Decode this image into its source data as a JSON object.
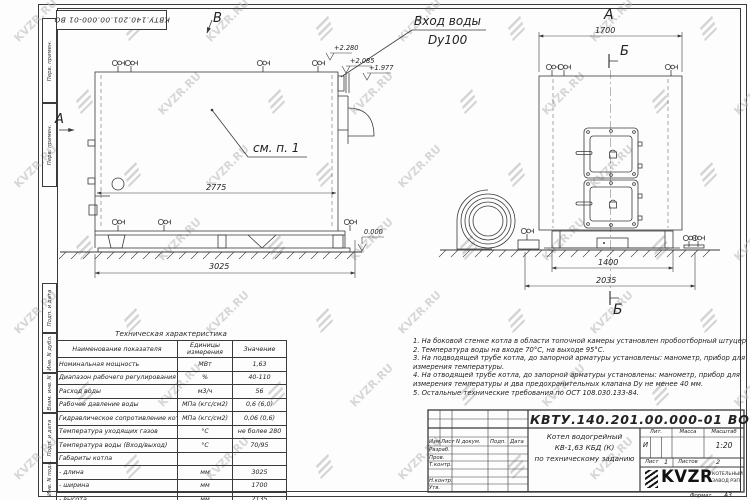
{
  "doc": {
    "number": "КВТУ.140.201.00.000-01 ВО"
  },
  "watermark": {
    "text": "KVZR.RU"
  },
  "frame": {
    "side_labels": [
      {
        "label": "Перв. примен."
      },
      {
        "label": "Перв. примен."
      },
      {
        "label": "Подп. и дата"
      },
      {
        "label": "Инв. N дубл."
      },
      {
        "label": "Взам. инв. N"
      },
      {
        "label": "Подп. и дата"
      },
      {
        "label": "Инв. N подл."
      }
    ]
  },
  "drawing": {
    "view_b": "В",
    "view_a_arrow": "А",
    "view_a_title": "А",
    "section_b_top": "Б",
    "section_b_bottom": "Б",
    "inlet_line1": "Вход воды",
    "inlet_line2": "Dy100",
    "see_note": "см. п. 1",
    "elev_2280": "+2.280",
    "elev_2085": "+2.085",
    "elev_1977": "+1.977",
    "elev_0": "0.000",
    "dim_2775": "2775",
    "dim_3025": "3025",
    "dim_1700": "1700",
    "dim_1400": "1400",
    "dim_2035": "2035"
  },
  "table": {
    "title": "Техническая характеристика",
    "headers": [
      "Наименование показателя",
      "Единицы измерения",
      "Значение"
    ],
    "rows": [
      [
        "Номинальная мощность",
        "МВт",
        "1,63"
      ],
      [
        "Диапазон рабочего регулирования",
        "%",
        "40-110"
      ],
      [
        "Расход воды",
        "м3/ч",
        "56"
      ],
      [
        "Рабочее давление воды",
        "МПа (кгс/см2)",
        "0,6 (6,0)"
      ],
      [
        "Гидравлическое сопротивление котла",
        "МПа (кгс/см2)",
        "0,06 (0,6)"
      ],
      [
        "Температура уходящих газов",
        "°С",
        "не более 280"
      ],
      [
        "Температура воды (Вход/выход)",
        "°С",
        "70/95"
      ],
      [
        "Габариты котла",
        "",
        ""
      ],
      [
        "    - длина",
        "мм",
        "3025"
      ],
      [
        "    - ширина",
        "мм",
        "1700"
      ],
      [
        "    - высота",
        "мм",
        "2135"
      ]
    ]
  },
  "notes": {
    "items": [
      "1.  На боковой стенке котла в области топочной камеры установлен пробоотборный штуцер",
      "2.  Температура воды на входе 70°С, на выходе 95°С.",
      "3.  На подводящей трубе котла, до запорной арматуры установлены: манометр, прибор для",
      "измерения температуры.",
      "4.  На отводящей трубе котла, до запорной арматуры установлены: манометр, прибор для",
      "измерения температуры и два предохранительных клапана  Dу не менее 40 мм.",
      "5.  Остальные технические требования по ОСТ 108.030.133-84."
    ]
  },
  "titleblock": {
    "col_izm": "Изм.",
    "col_list": "Лист",
    "col_ndoc": "N докум.",
    "col_podp": "Подп.",
    "col_data": "Дата",
    "row_razrab": "Разраб.",
    "row_prov": "Пров.",
    "row_tkontr": "Т.контр.",
    "row_nkontr": "Н.контр.",
    "row_utv": "Утв.",
    "name_line1": "Котел водогрейный",
    "name_line2": "КВ-1,63 КБД (К)",
    "name_line3": "по техническому заданию",
    "lit_label": "Лит.",
    "lit_value": "И",
    "mass_label": "Масса",
    "scale_label": "Масштаб",
    "scale_value": "1:20",
    "sheet_label": "Лист",
    "sheet_value": "1",
    "sheets_label": "Листов",
    "sheets_value": "2",
    "company_name": "KVZR",
    "company_line1": "КОТЕЛЬНЫЙ",
    "company_line2": "ЗАВОД РЭП",
    "format_label": "Формат",
    "format_value": "А3"
  }
}
